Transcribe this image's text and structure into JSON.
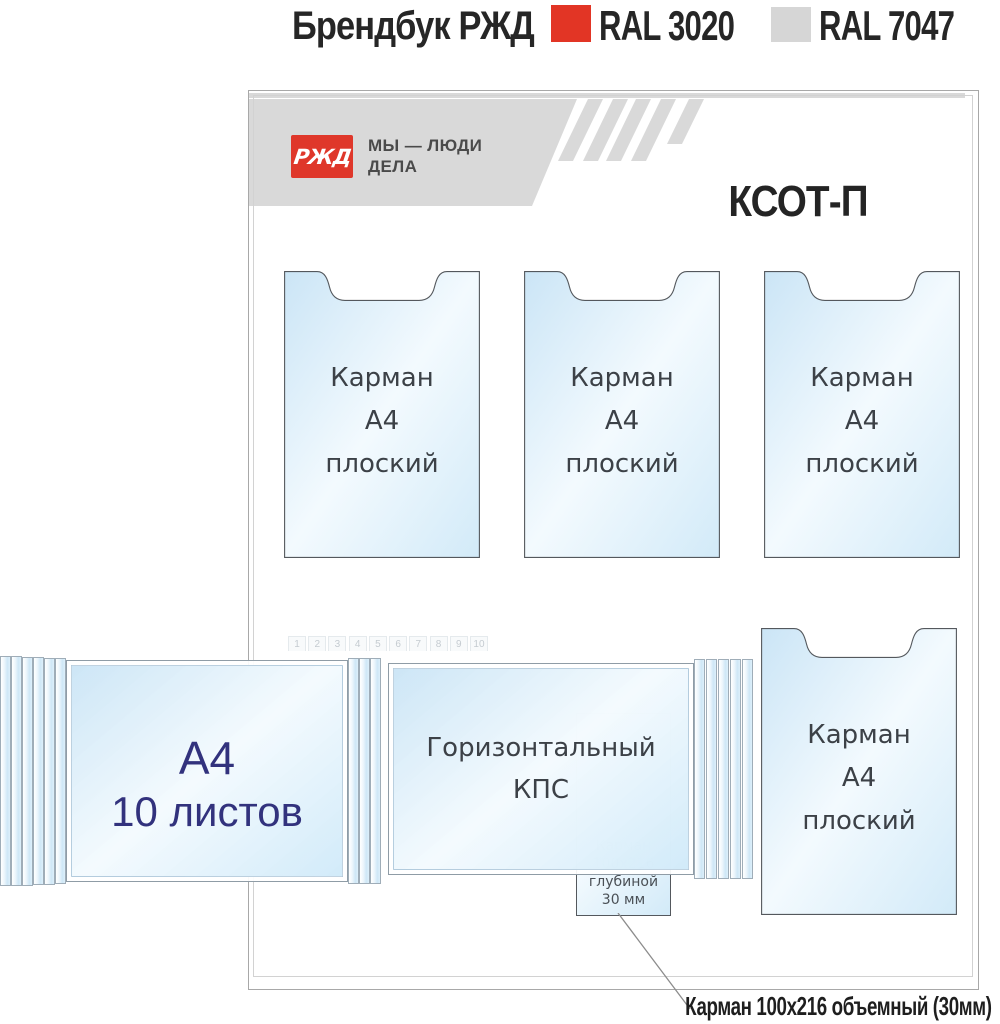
{
  "titlebar": {
    "title": "Брендбук РЖД",
    "swatch_red_label": "RAL 3020",
    "swatch_gray_label": "RAL 7047"
  },
  "header": {
    "logo_text": "РЖД",
    "slogan_line1": "МЫ — ЛЮДИ",
    "slogan_line2": "ДЕЛА",
    "stand_title": "КСОТ-П"
  },
  "pocket_a4": {
    "line1": "Карман",
    "line2": "А4",
    "line3": "плоский"
  },
  "flipbook_a4": {
    "line1": "А4",
    "line2": "10 листов"
  },
  "flipbook_kps": {
    "line1": "Горизонтальный",
    "line2": "КПС"
  },
  "pocket_small": {
    "line1": "Карман",
    "line2": "100x216",
    "line3": "глубиной",
    "line4": "30 мм"
  },
  "flip_tabs": [
    "1",
    "2",
    "3",
    "4",
    "5",
    "6",
    "7",
    "8",
    "9",
    "10"
  ],
  "callout_label": "Карман 100x216 объемный (30мм)",
  "colors": {
    "ral_3020": "#e23525",
    "ral_7047": "#d6d6d6",
    "band_gray": "#d9d9d9",
    "logo_red": "#df372a",
    "navy_text": "#32327d"
  }
}
